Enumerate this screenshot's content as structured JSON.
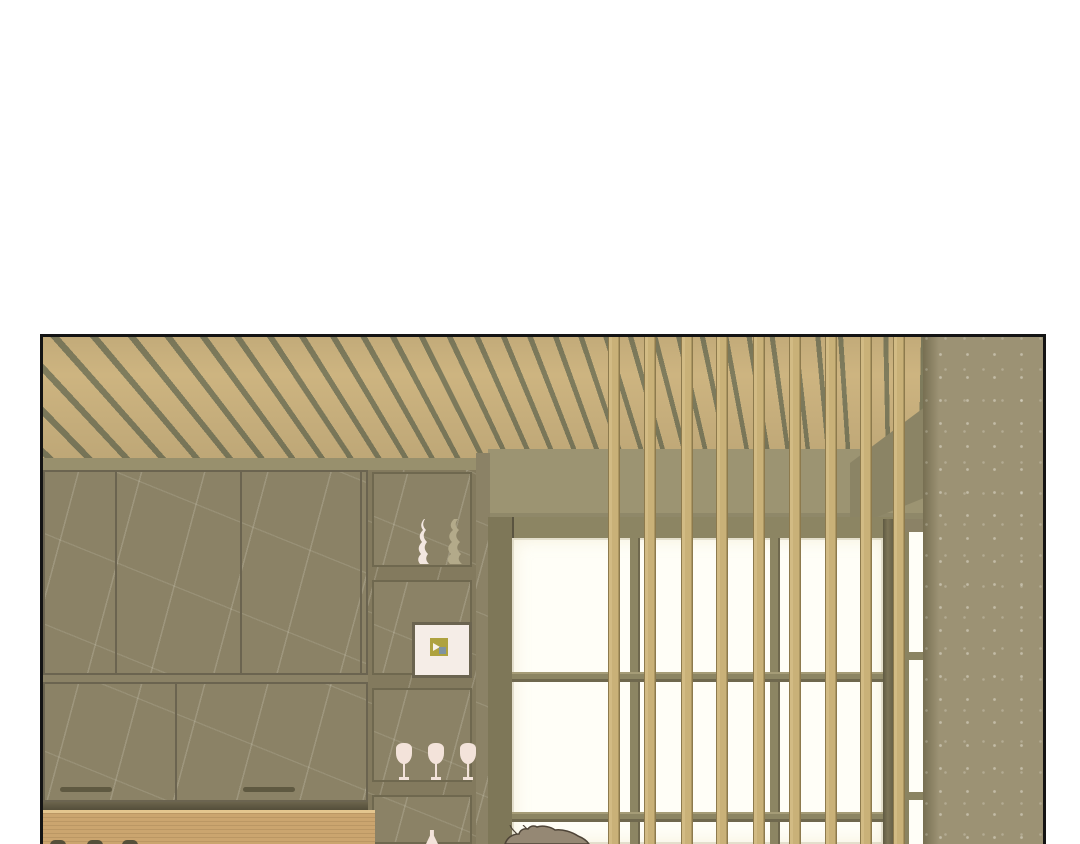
{
  "meta": {
    "description": "Webtoon comic panel: empty Japanese-style bar interior with slatted wood ceiling, marble cabinets, display shelves, shoji window behind a vertical wooden slat screen, and the top of a character's head at bottom",
    "visible_text": ""
  },
  "colors": {
    "page-bg": "#ffffff",
    "ink": "#141414",
    "ceiling-tan": "#cdb480",
    "ceiling-gap": "#7f7c5d",
    "gray-band": "#98906d",
    "marble": "#8b8266",
    "handle": "#5f5941",
    "soffit": "#9c9472",
    "frame-olive": "#8c8563",
    "pane": "#fffef7",
    "slat": "#c9b178",
    "slat-edge": "#8d7a4d",
    "wall": "#9c9274",
    "wall-shade": "#776f52",
    "counter": "#cba56f",
    "counter-hl": "#e4c68f",
    "matte": "#f5ede7",
    "art": "#aea23f",
    "art-accent": "#7f93a0",
    "glass": "#f3e3da",
    "vase-light": "#f3e7e0",
    "vase-dark": "#b3aa8a",
    "jar": "#55503a",
    "hair": "#958874",
    "hair-line": "#4e4437"
  },
  "scene": {
    "ceiling": {
      "label": "fanned wooden slat ceiling"
    },
    "cabinets": {
      "label": "marble cabinet wall",
      "upper_panels": 3,
      "lower_panels": 2,
      "handles": 2
    },
    "shelf_column": {
      "niches": [
        {
          "label": "two wavy decorative vases",
          "count": 2
        },
        {
          "label": "framed artwork",
          "count": 1
        },
        {
          "label": "wine glasses",
          "count": 3
        },
        {
          "label": "bottle",
          "count": 1
        }
      ]
    },
    "window": {
      "label": "shoji window behind vertical wooden slat screen",
      "screen_slats": 9
    },
    "counter": {
      "label": "wooden counter",
      "jars": 3
    },
    "character": {
      "label": "top of a person's head (brown hair)"
    }
  }
}
